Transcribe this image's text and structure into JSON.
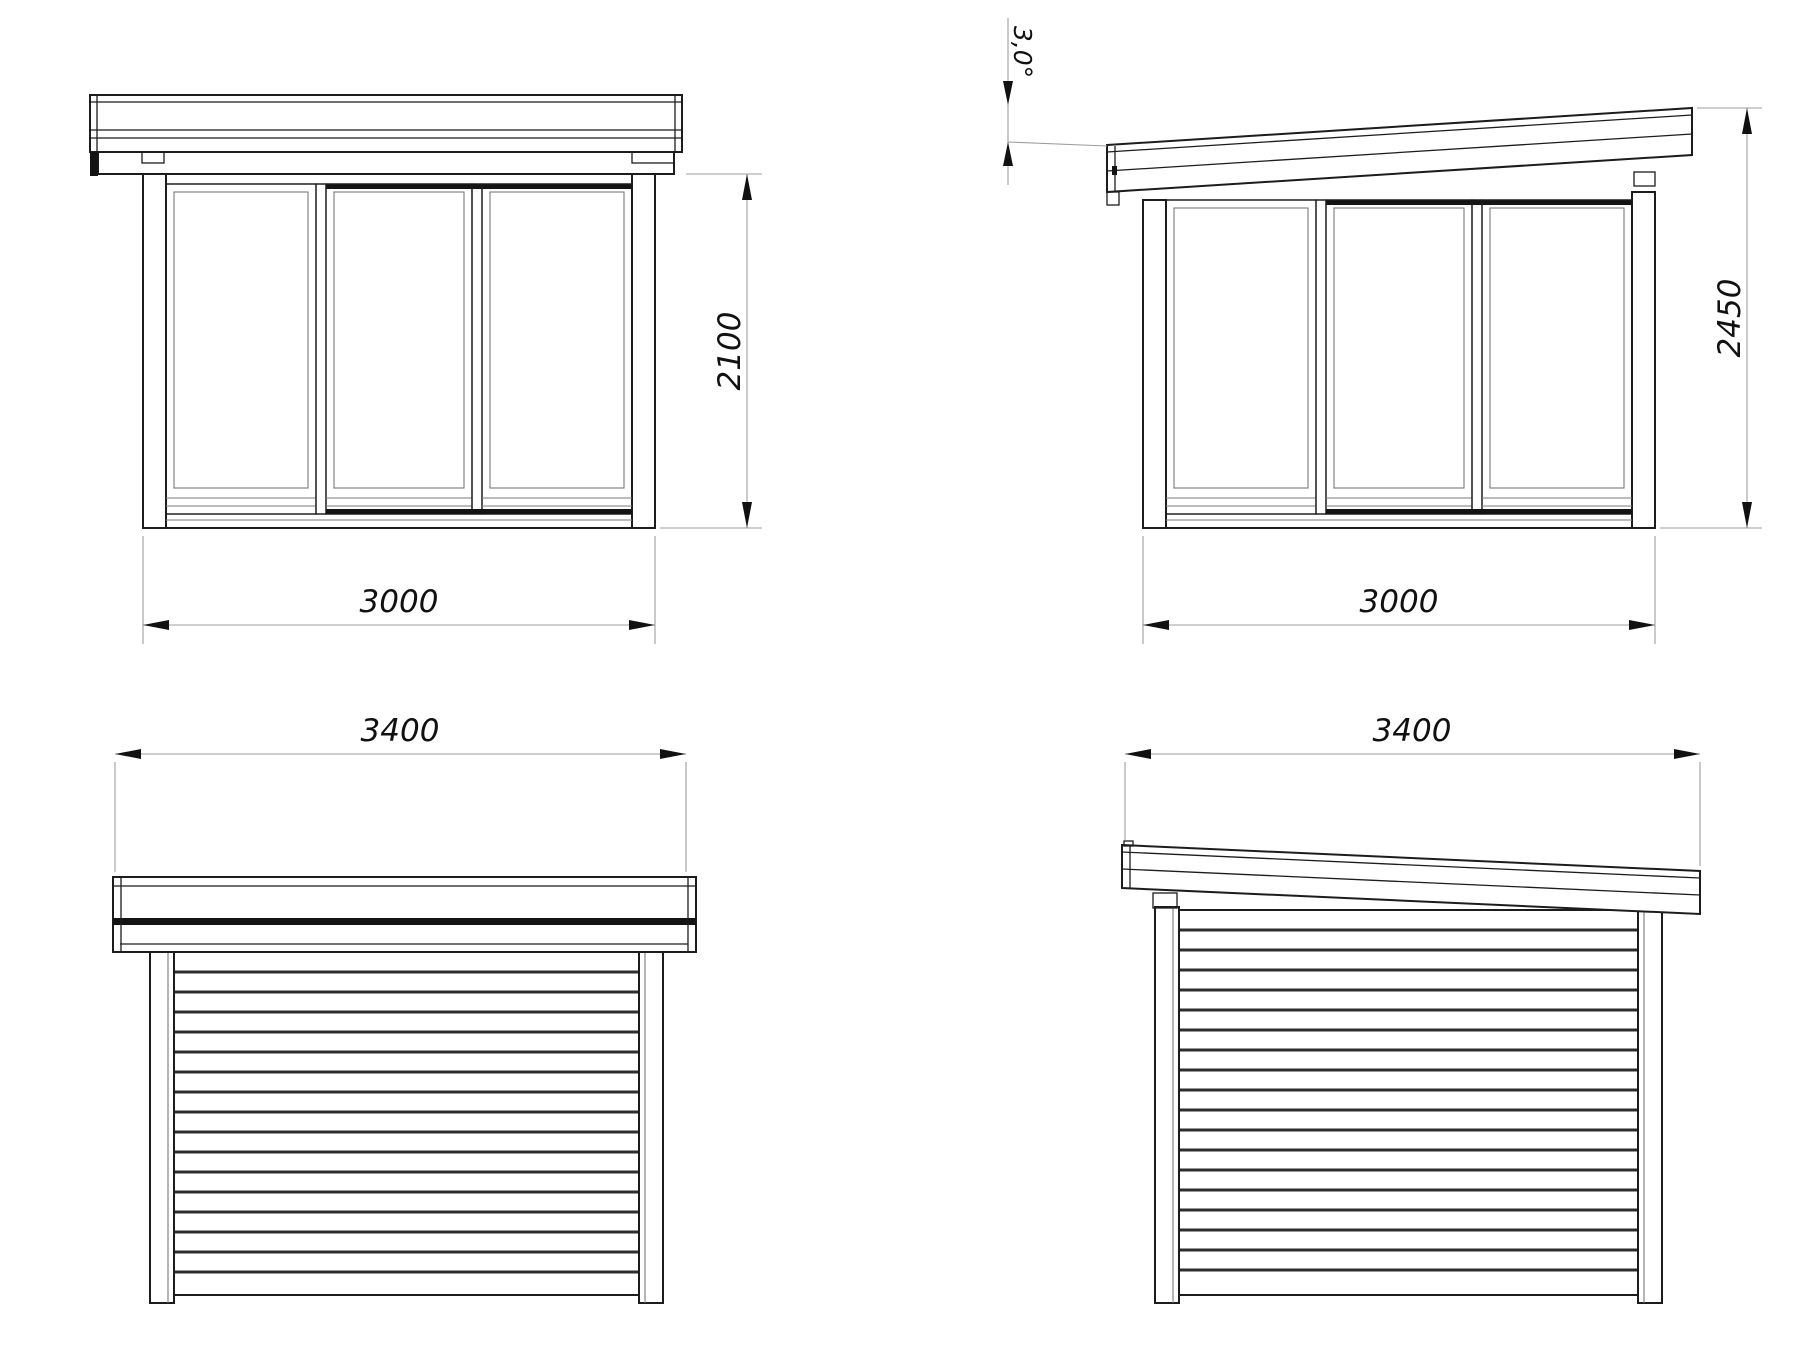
{
  "drawing": {
    "views": {
      "front_flat_roof": {
        "width_label": "3000",
        "height_label": "2100"
      },
      "front_pent_roof": {
        "width_label": "3000",
        "height_label": "2450",
        "roof_angle_label": "3,0°"
      },
      "side_flat_roof": {
        "width_label": "3400"
      },
      "side_pent_roof": {
        "width_label": "3400"
      }
    },
    "colors": {
      "line": "#1c1c1c",
      "dimension_line": "#9e9e9e",
      "text": "#111111",
      "accent_black": "#141414",
      "background": "#ffffff"
    }
  }
}
